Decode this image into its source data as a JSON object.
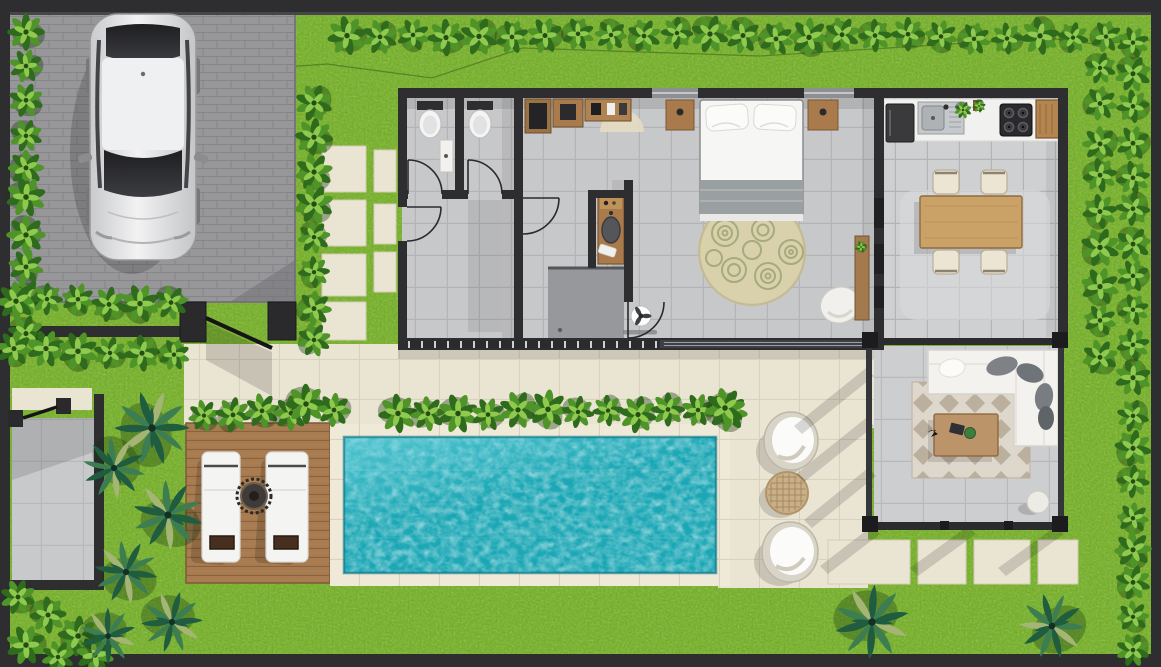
{
  "scene": {
    "type": "floor-plan",
    "title": "villa-floor-plan-top-view",
    "description": "Top-down 3D rendered floor plan of a pool villa: parking with car, garden with hedges and palms, two WCs, utility room, dressing hall, bathroom with shower, bedroom, kitchen with dining area, open living sala, swimming pool, timber sun deck and terraces",
    "visible_text": []
  },
  "palette": {
    "grass": "#74ad2b",
    "grassLight": "#a9d052",
    "grassDark": "#3f7a12",
    "hedgeDark": "#2f6b1c",
    "hedgeMid": "#4f9428",
    "hedgeLight": "#8fc94e",
    "hedgeShadow": "#1b3a0e",
    "palmDark": "#1f5c40",
    "palmMid": "#3c7d52",
    "palmLight": "#a4b575",
    "wall": "#2e2e31",
    "wallMid": "#46464a",
    "post": "#1c1c1e",
    "brick": "#97979a",
    "brickLine": "#828287",
    "tile": "#c7c8ca",
    "grout": "#b3b4b6",
    "tileLight": "#cfd0d2",
    "cream": "#eae4d3",
    "creamLine": "#d9d2bd",
    "coping": "#efe9d8",
    "water": "#18a6b5",
    "waterDeep": "#0b7484",
    "waterLight": "#7fdce4",
    "deck": "#a87c50",
    "deckLine": "#7e5a38",
    "woodLight": "#caa267",
    "wood": "#a87a4c",
    "woodDark": "#7c5630",
    "whiteFurn": "#f4f3ef",
    "fabricGray": "#7e8286",
    "blanket": "#9aa0a1",
    "rugBeige": "#d9d1ac",
    "rugRing": "#9aa06e",
    "livRugBase": "#ded7cb",
    "livRugTri": "#b5a897",
    "steel": "#c6c9cb",
    "appliance": "#313134"
  },
  "rooms": [
    {
      "id": "parking",
      "name": "parking-driveway"
    },
    {
      "id": "wc1",
      "name": "guest-wc-1"
    },
    {
      "id": "wc2",
      "name": "guest-wc-2"
    },
    {
      "id": "utility",
      "name": "utility-room"
    },
    {
      "id": "hall",
      "name": "dressing-hall"
    },
    {
      "id": "bath",
      "name": "bathroom-with-shower"
    },
    {
      "id": "bedroom",
      "name": "bedroom"
    },
    {
      "id": "kitchen",
      "name": "kitchen-dining"
    },
    {
      "id": "sala",
      "name": "open-living-sala"
    },
    {
      "id": "pool",
      "name": "swimming-pool"
    },
    {
      "id": "deck",
      "name": "timber-sun-deck"
    },
    {
      "id": "patio",
      "name": "side-patio"
    },
    {
      "id": "terrace",
      "name": "pool-terrace"
    },
    {
      "id": "garden",
      "name": "garden"
    }
  ],
  "objects": [
    "white-car",
    "double-bed",
    "nightstand-left",
    "nightstand-right",
    "round-rug",
    "bedroom-armchair",
    "wall-console",
    "ceiling-fan",
    "wardrobes",
    "toilet-1",
    "toilet-2",
    "wc-vanity",
    "bath-vanity-sink",
    "shower",
    "fridge",
    "kitchen-sink",
    "stove",
    "kitchen-cabinet",
    "dining-table",
    "dining-chairs-x4",
    "l-shaped-sofa",
    "coffee-table",
    "side-stool",
    "outdoor-rug",
    "sun-lounger-1",
    "sun-lounger-2",
    "deck-table",
    "papasan-chair-1",
    "papasan-chair-2",
    "rattan-table",
    "main-gate",
    "side-gate",
    "hedge-shrubs",
    "palm-trees",
    "stepping-stones"
  ]
}
